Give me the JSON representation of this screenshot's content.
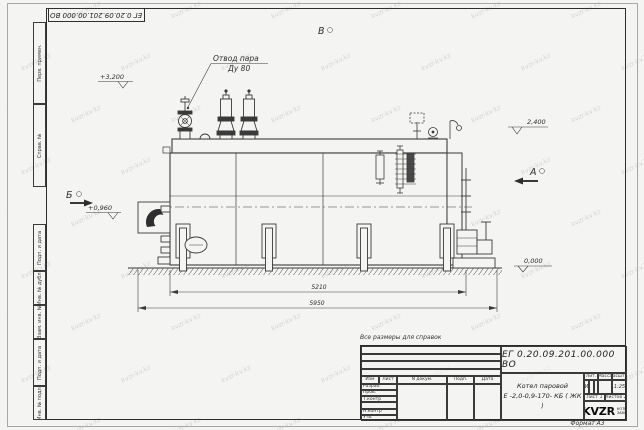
{
  "sheet": {
    "watermark": "kvzr-kv.kz",
    "note": "Все размеры для справок",
    "format_label": "Формат А3",
    "top_doc_number": "ЕГ 0.20.09.201.00.000  ВО"
  },
  "frame": {
    "left_top_cells": [
      "Перв. примен.",
      "Справ. №"
    ],
    "left_bottom_cells": [
      "Подп. и дата",
      "Инв. № дубл.",
      "Взам. инв. №",
      "Подп. и дата",
      "Инв. № подл."
    ]
  },
  "title_block": {
    "doc_number": "ЕГ 0.20.09.201.00.000  ВО",
    "product_line1": "Котел паровой",
    "product_line2": "Е -2,0-0,9-170- КБ ( ЖК )",
    "cols": [
      "Изм",
      "Лист",
      "N докум.",
      "Подп.",
      "Дата"
    ],
    "rows": [
      "Разраб.",
      "Пров.",
      "Т.контр",
      "",
      "Н.контр",
      "Утв."
    ],
    "lit_header": "Лит.",
    "mass_header": "Масса",
    "scale_header": "Масштаб",
    "lit_value": "И",
    "scale_value": "1:25",
    "sheet_word": "Лист",
    "sheet_num": "1",
    "sheets_word": "Листов",
    "sheets_num": "2",
    "logo": "KVZR",
    "logo_caption1": "КОТЕЛЬНЫЙ",
    "logo_caption2": "ЗАВОД РЗР"
  },
  "drawing": {
    "callout_line1": "Отвод пара",
    "callout_line2": "Ду 80",
    "views": {
      "a": "А",
      "b": "Б",
      "v": "В"
    },
    "elevations": {
      "top": "+3,200",
      "deck": "2,400",
      "burner": "+0,960",
      "ground": "0,000"
    },
    "dims": {
      "body_length": "5210",
      "overall_length": "5950"
    }
  }
}
